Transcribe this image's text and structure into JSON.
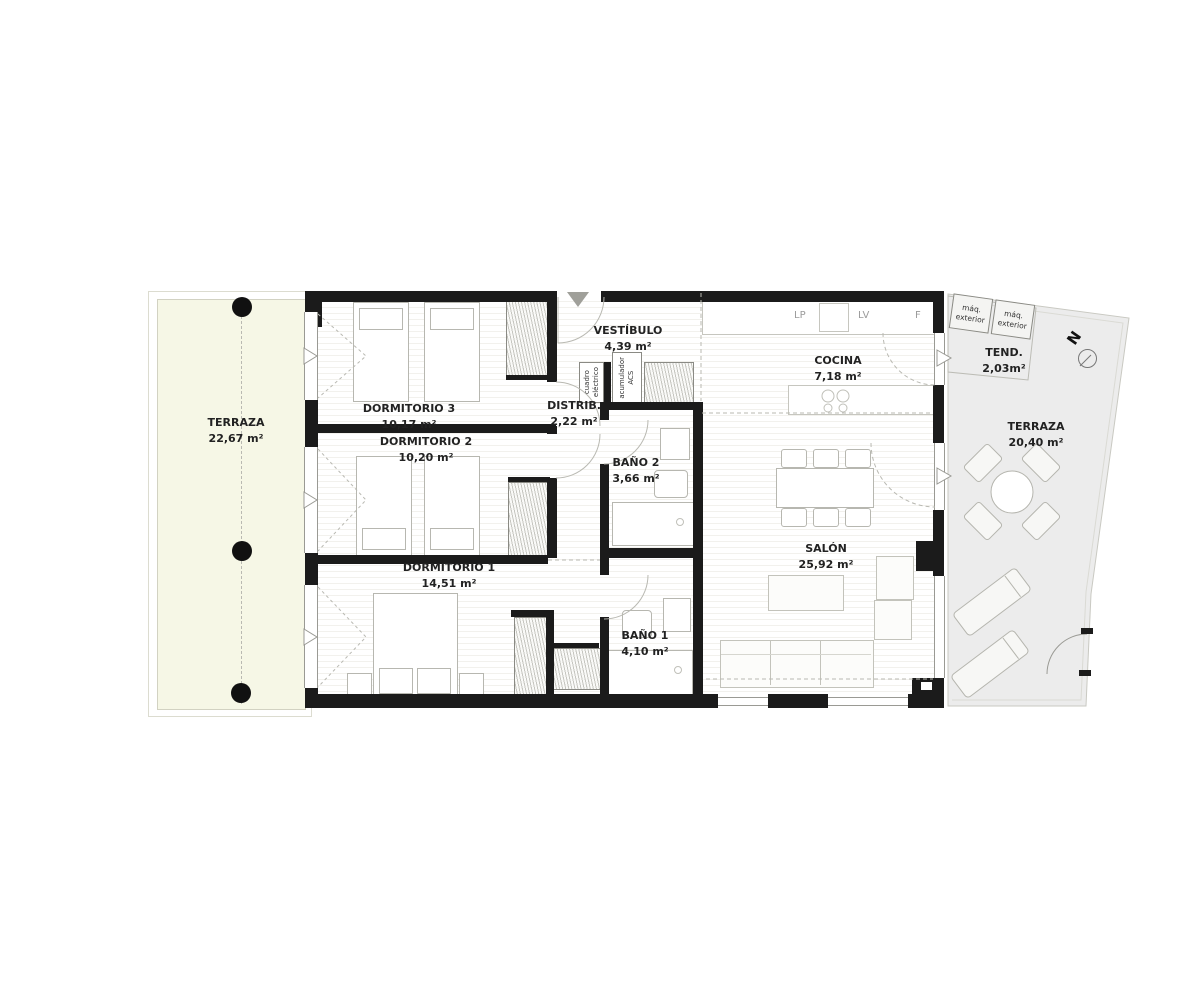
{
  "rooms": {
    "terraza_izq": {
      "name": "TERRAZA",
      "area": "22,67 m²"
    },
    "dormitorio3": {
      "name": "DORMITORIO 3",
      "area": "10,17 m²"
    },
    "dormitorio2": {
      "name": "DORMITORIO 2",
      "area": "10,20 m²"
    },
    "dormitorio1": {
      "name": "DORMITORIO 1",
      "area": "14,51 m²"
    },
    "vestibulo": {
      "name": "VESTÍBULO",
      "area": "4,39 m²"
    },
    "distribuidor": {
      "name": "DISTRIB.",
      "area": "2,22 m²"
    },
    "bano2": {
      "name": "BAÑO 2",
      "area": "3,66 m²"
    },
    "bano1": {
      "name": "BAÑO 1",
      "area": "4,10 m²"
    },
    "cocina": {
      "name": "COCINA",
      "area": "7,18 m²"
    },
    "salon": {
      "name": "SALÓN",
      "area": "25,92 m²"
    },
    "terraza_der": {
      "name": "TERRAZA",
      "area": "20,40 m²"
    },
    "tendedero": {
      "name": "TEND.",
      "area": "2,03m²"
    }
  },
  "equipment": {
    "maq_exterior_1": "máq.\nexterior",
    "maq_exterior_2": "máq.\nexterior",
    "cuadro_electrico": "cuadro\neléctrico",
    "acumulador_acs": "acumulador\nACS",
    "lavadora": "LP",
    "lavavajillas": "LV",
    "frigorifico": "F"
  },
  "compass": {
    "north": "N"
  },
  "colors": {
    "wall": "#1b1b1b",
    "terrace_left_fill": "#f6f7e6",
    "terrace_right_fill": "#ececec",
    "drawing_line": "#b9b9b2",
    "label_text": "#222222"
  }
}
